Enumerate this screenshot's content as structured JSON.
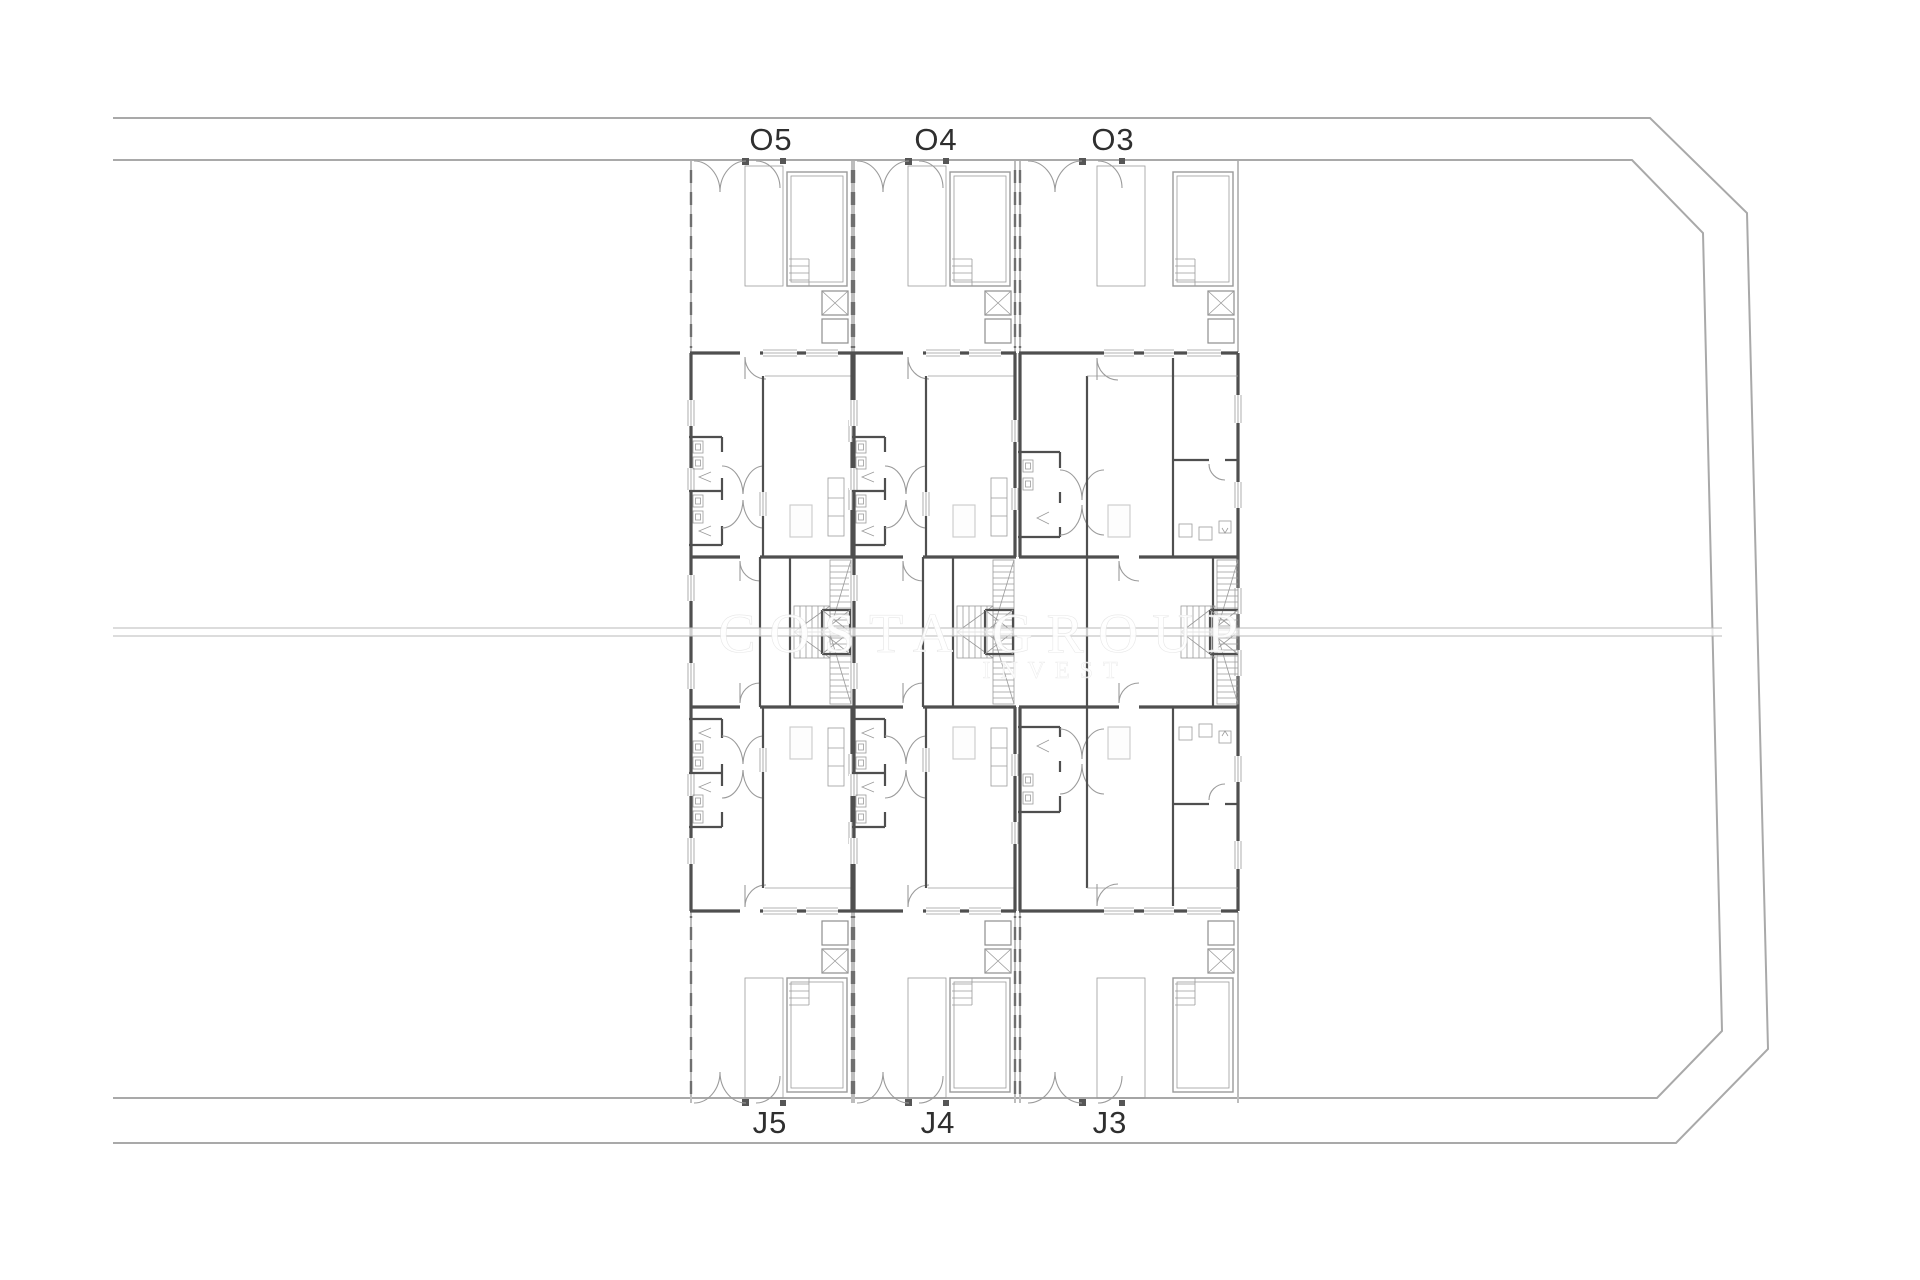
{
  "plan": {
    "top_labels": [
      {
        "text": "O5"
      },
      {
        "text": "O4"
      },
      {
        "text": "O3"
      }
    ],
    "bottom_labels": [
      {
        "text": "J5"
      },
      {
        "text": "J4"
      },
      {
        "text": "J3"
      }
    ],
    "watermark": {
      "line1": "COSTA GROUP",
      "line2": "INVEST"
    },
    "colors": {
      "wall": "#4f4f4f",
      "ltline": "#9b9b9b",
      "boundary": "#a9a9a9",
      "furn": "#c9c9c9",
      "label": "#2f2f2f",
      "fence": "#bdbdbd",
      "fencedash": "#6f6f6f"
    }
  }
}
